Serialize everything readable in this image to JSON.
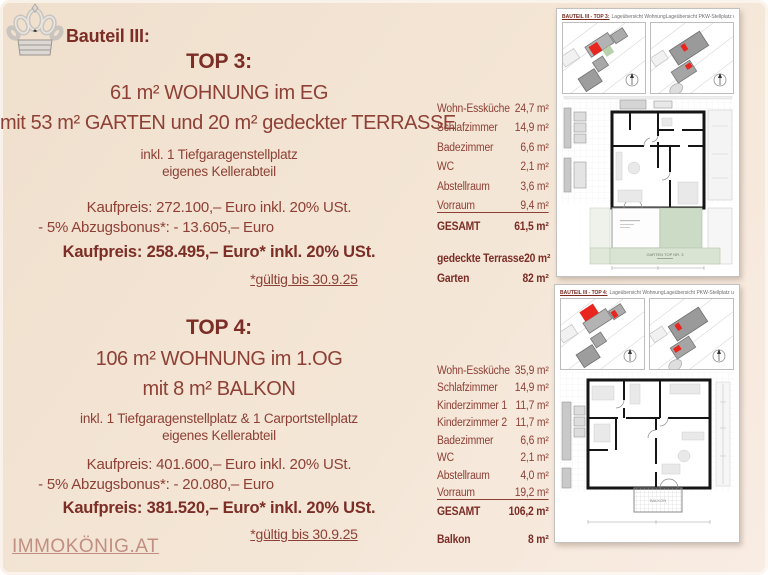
{
  "brand": {
    "website": "IMMOKÖNIG.AT"
  },
  "heading": "Bauteil III:",
  "top3": {
    "title": "TOP 3:",
    "subtitle1": "61 m² WOHNUNG im EG",
    "subtitle2": "mit 53 m² GARTEN und 20 m² gedeckter TERRASSE",
    "includes1": "inkl. 1 Tiefgaragenstellplatz",
    "includes2": "eigenes Kellerabteil",
    "price_gross": "Kaufpreis: 272.100,– Euro inkl. 20% USt.",
    "discount": "- 5% Abzugsbonus*: - 13.605,– Euro",
    "price_final": "Kaufpreis: 258.495,– Euro* inkl. 20% USt.",
    "validity": "*gültig bis 30.9.25",
    "rooms": [
      {
        "label": "Wohn-Essküche",
        "value": "24,7 m²"
      },
      {
        "label": "Schlafzimmer",
        "value": "14,9 m²"
      },
      {
        "label": "Badezimmer",
        "value": "6,6 m²"
      },
      {
        "label": "WC",
        "value": "2,1 m²"
      },
      {
        "label": "Abstellraum",
        "value": "3,6 m²"
      },
      {
        "label": "Vorraum",
        "value": "9,4 m²"
      }
    ],
    "total": {
      "label": "GESAMT",
      "value": "61,5 m²"
    },
    "extras": [
      {
        "label": "gedeckte Terrasse",
        "value": "20 m²"
      },
      {
        "label": "Garten",
        "value": "82 m²"
      }
    ],
    "plan": {
      "header_title": "BAUTEIL III - TOP 3:",
      "header_sub1": "Lageübersicht Wohnung",
      "header_sub2": "Lageübersicht PKW-Stellplatz und Kellerabteil",
      "garden_label": "GARTEN TOP NR. 3"
    }
  },
  "top4": {
    "title": "TOP 4:",
    "subtitle1": "106 m² WOHNUNG im 1.OG",
    "subtitle2": "mit 8 m² BALKON",
    "includes1": "inkl. 1 Tiefgaragenstellplatz & 1 Carportstellplatz",
    "includes2": "eigenes Kellerabteil",
    "price_gross": "Kaufpreis: 401.600,– Euro inkl. 20% USt.",
    "discount": "- 5% Abzugsbonus*: - 20.080,– Euro",
    "price_final": "Kaufpreis: 381.520,– Euro* inkl. 20% USt.",
    "validity": "*gültig bis 30.9.25",
    "rooms": [
      {
        "label": "Wohn-Essküche",
        "value": "35,9 m²"
      },
      {
        "label": "Schlafzimmer",
        "value": "14,9 m²"
      },
      {
        "label": "Kinderzimmer 1",
        "value": "11,7 m²"
      },
      {
        "label": "Kinderzimmer 2",
        "value": "11,7 m²"
      },
      {
        "label": "Badezimmer",
        "value": "6,6 m²"
      },
      {
        "label": "WC",
        "value": "2,1 m²"
      },
      {
        "label": "Abstellraum",
        "value": "4,0 m²"
      },
      {
        "label": "Vorraum",
        "value": "19,2 m²"
      }
    ],
    "total": {
      "label": "GESAMT",
      "value": "106,2 m²"
    },
    "extras": [
      {
        "label": "Balkon",
        "value": "8 m²"
      }
    ],
    "plan": {
      "header_title": "BAUTEIL III - TOP 4:",
      "header_sub1": "Lageübersicht Wohnung",
      "header_sub2": "Lageübersicht PKW-Stellplatz und Kellerabteil",
      "balcony_label": "BALKON"
    }
  }
}
